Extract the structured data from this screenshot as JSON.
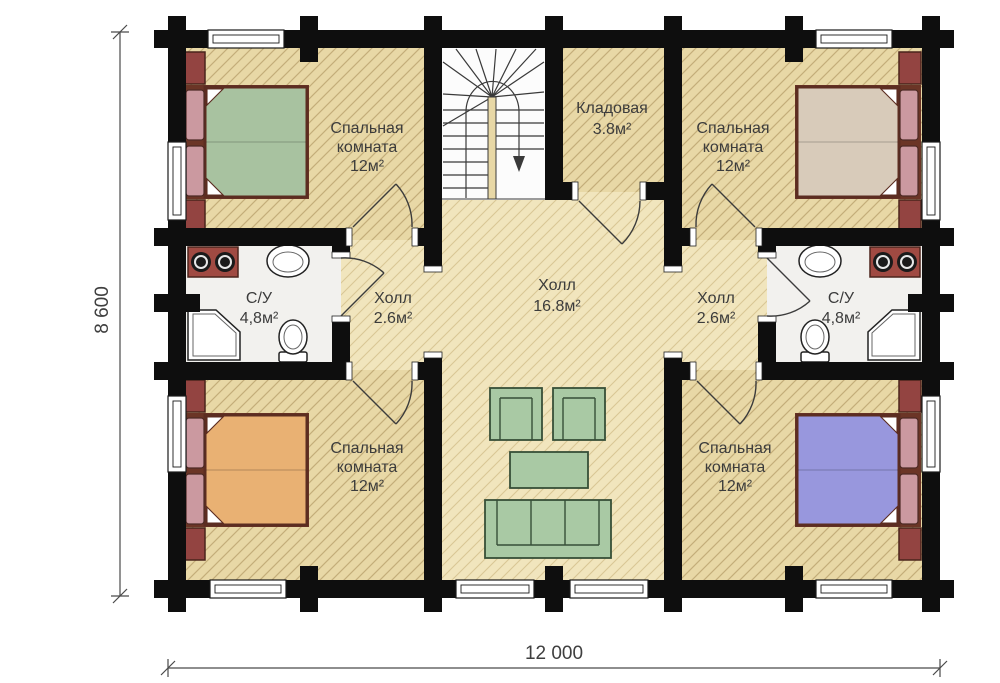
{
  "rooms": {
    "bedroom_tl": {
      "line1": "Спальная",
      "line2": "комната",
      "area": "12м²"
    },
    "bedroom_tr": {
      "line1": "Спальная",
      "line2": "комната",
      "area": "12м²"
    },
    "bedroom_bl": {
      "line1": "Спальная",
      "line2": "комната",
      "area": "12м²"
    },
    "bedroom_br": {
      "line1": "Спальная",
      "line2": "комната",
      "area": "12м²"
    },
    "storage": {
      "name": "Кладовая",
      "area": "3.8м²"
    },
    "hall_center": {
      "name": "Холл",
      "area": "16.8м²"
    },
    "hall_left": {
      "name": "Холл",
      "area": "2.6м²"
    },
    "hall_right": {
      "name": "Холл",
      "area": "2.6м²"
    },
    "bath_left": {
      "name": "С/У",
      "area": "4,8м²"
    },
    "bath_right": {
      "name": "С/У",
      "area": "4,8м²"
    }
  },
  "dimensions": {
    "width": "12 000",
    "height": "8 600"
  },
  "colors": {
    "wall": "#0e0e0e",
    "bedroom_floor": "#e8d8a6",
    "bedroom_hatch": "#c4ae79",
    "hall_floor": "#f1e5bd",
    "hall_hatch": "#d9c795",
    "bath_floor": "#f2f1ee",
    "stair_floor": "#fcfcfc",
    "bed_green": "#a8c2a0",
    "bed_tan": "#d8cbba",
    "bed_orange": "#e9b173",
    "bed_blue": "#9897dd",
    "pillow": "#cb99a0",
    "nightstand": "#934441",
    "washer_body": "#a04a42",
    "furniture_green": "#a9c9a4"
  }
}
